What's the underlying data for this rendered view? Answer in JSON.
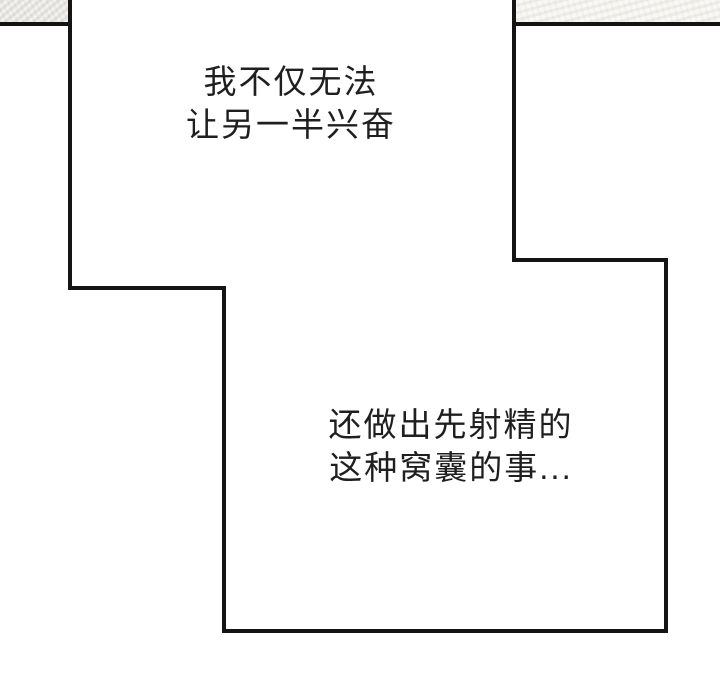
{
  "colors": {
    "bg": "#ffffff",
    "ink": "#141414",
    "paper-left": "#e9e6e1",
    "paper-right": "#f2f0ea",
    "text": "#1f1f1f"
  },
  "dialogue1": {
    "line1": "我不仅无法",
    "line2": "让另一半兴奋"
  },
  "dialogue2": {
    "line1": "还做出先射精的",
    "line2": "这种窝囊的事..."
  }
}
